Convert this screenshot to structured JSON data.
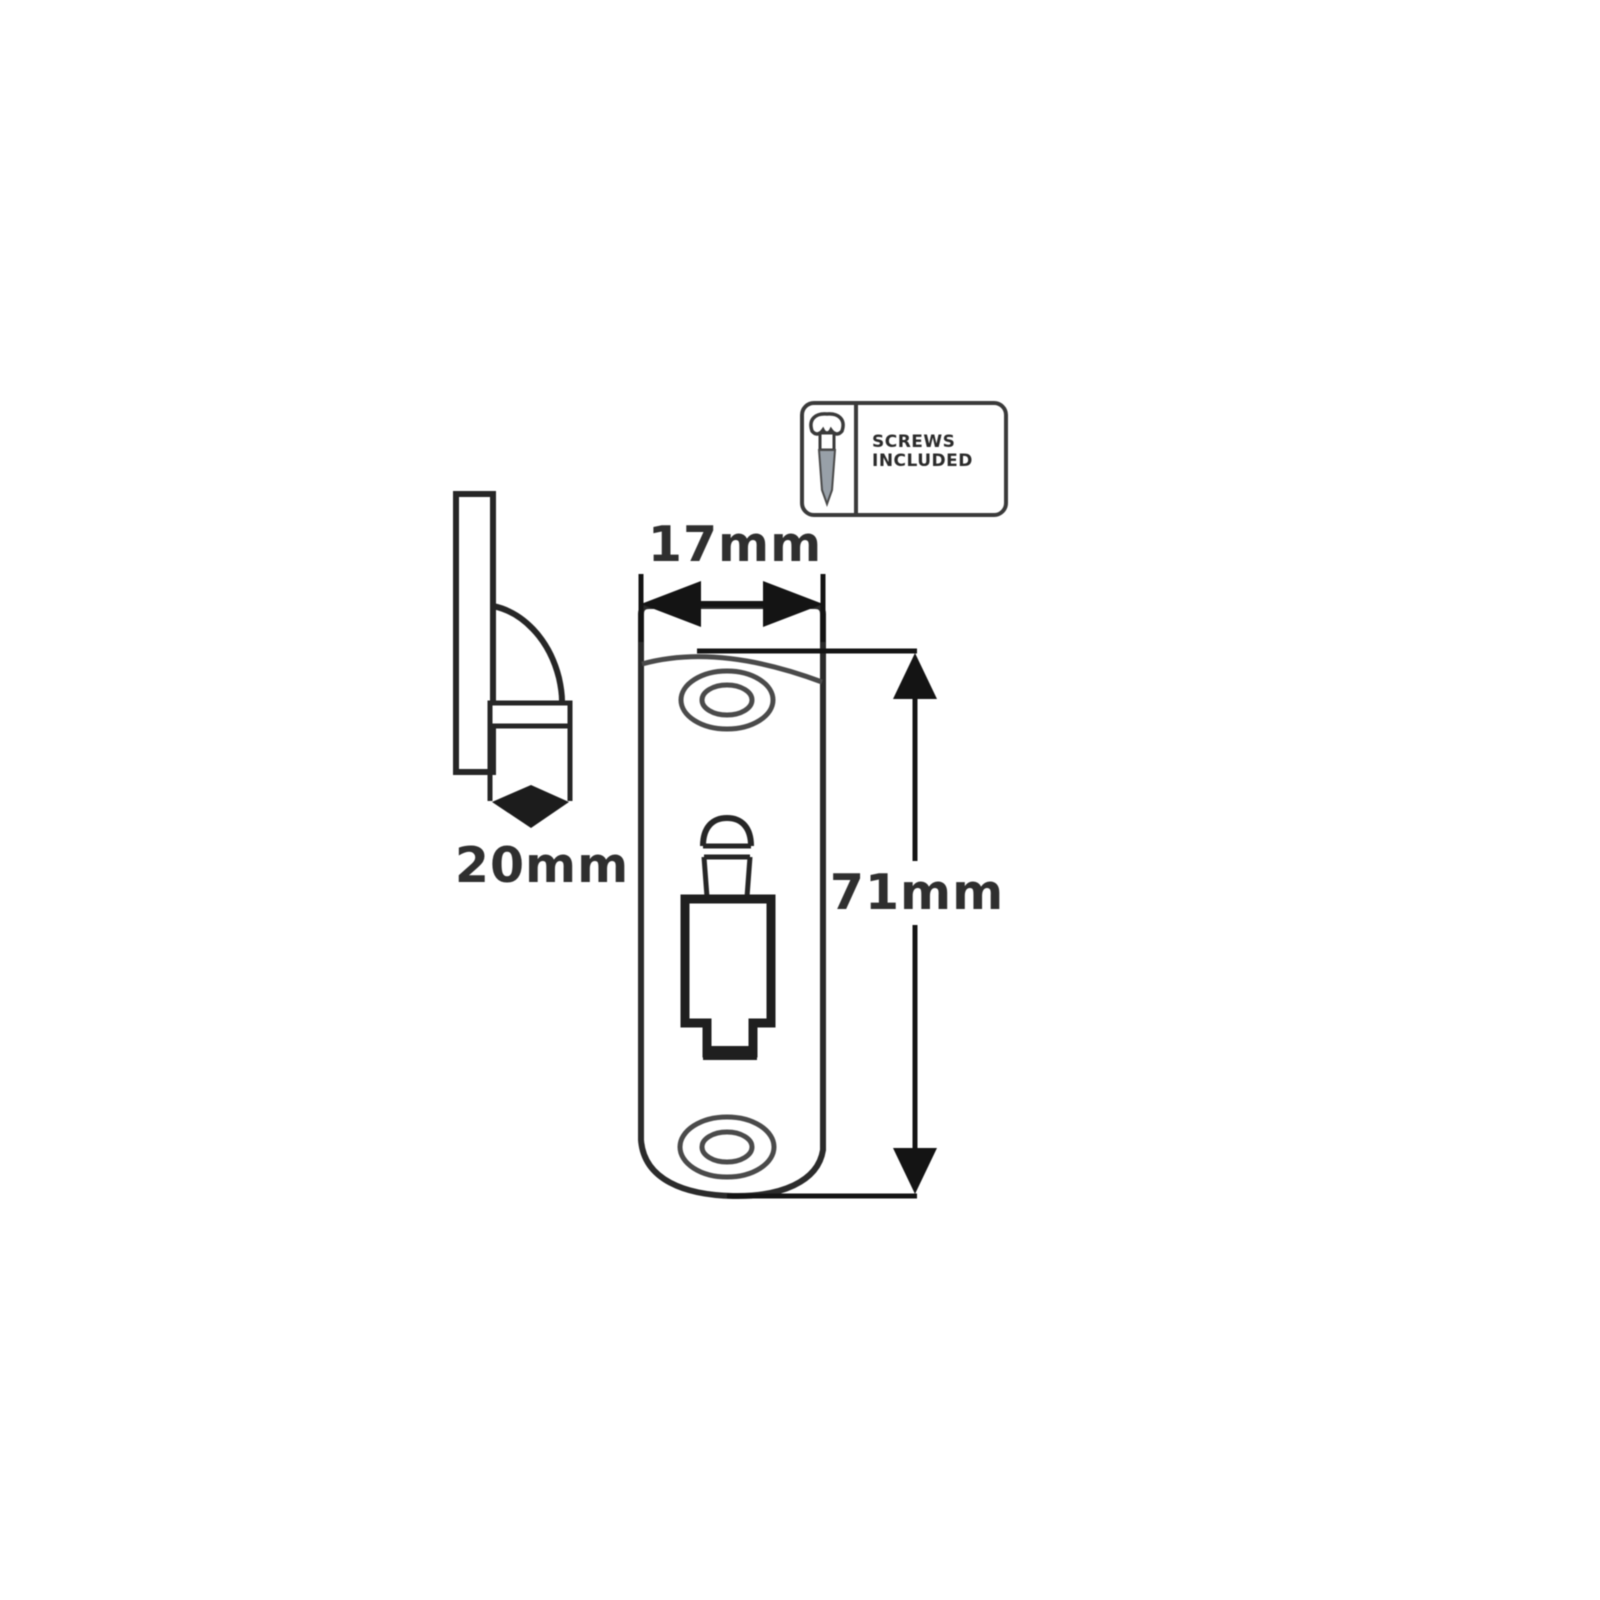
{
  "canvas": {
    "width": 1600,
    "height": 1600,
    "background": "#ffffff"
  },
  "colors": {
    "line": "#262626",
    "soft_line": "#4a4a4a",
    "dimension": "#141414",
    "label_text": "#2f2f2f",
    "badge_border": "#3a3a3a",
    "screw_shank_fill": "#98a0a8"
  },
  "labels": {
    "width": "17mm",
    "height": "71mm",
    "depth": "20mm"
  },
  "badge": {
    "line1": "SCREWS",
    "line2": "INCLUDED",
    "icon": "screw-icon"
  }
}
